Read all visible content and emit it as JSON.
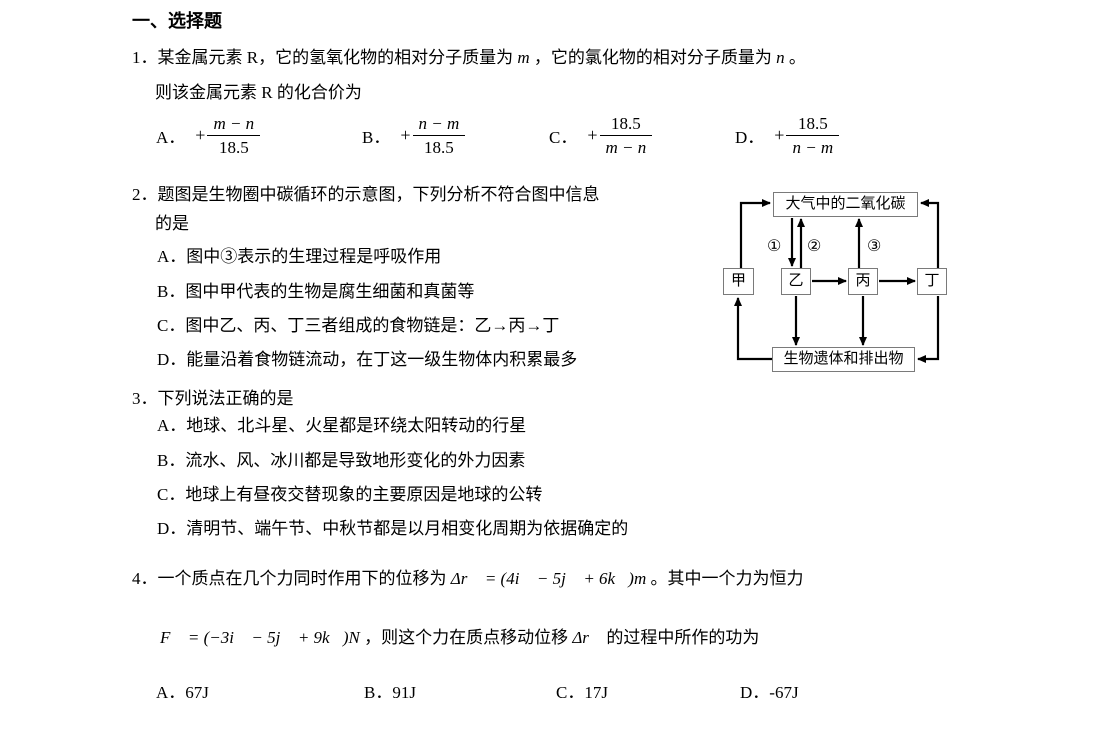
{
  "page": {
    "heading": "一、选择题"
  },
  "q1": {
    "number": "1．",
    "line1": {
      "a": "某金属元素 R，它的氢氧化物的相对分子质量为 ",
      "m": "m",
      "b": " ，它的氯化物的相对分子质量为 ",
      "n": "n",
      "c": " 。"
    },
    "line2": "则该金属元素 R 的化合价为",
    "plus": "+",
    "options": [
      {
        "label": "A．",
        "num": "m − n",
        "den": "18.5"
      },
      {
        "label": "B．",
        "num": "n − m",
        "den": "18.5"
      },
      {
        "label": "C．",
        "num": "18.5",
        "den": "m − n"
      },
      {
        "label": "D．",
        "num": "18.5",
        "den": "n − m"
      }
    ]
  },
  "q2": {
    "number": "2．",
    "line1": "题图是生物圈中碳循环的示意图，下列分析不符合图中信息",
    "line2": "的是",
    "options": [
      "A．图中③表示的生理过程是呼吸作用",
      "B．图中甲代表的生物是腐生细菌和真菌等",
      "C．图中乙、丙、丁三者组成的食物链是：乙→丙→丁",
      "D．能量沿着食物链流动，在丁这一级生物体内积累最多"
    ]
  },
  "diagram": {
    "top_box": "大气中的二氧化碳",
    "box_jia": "甲",
    "box_yi": "乙",
    "box_bing": "丙",
    "box_ding": "丁",
    "bottom_box": "生物遗体和排出物",
    "label_1": "①",
    "label_2": "②",
    "label_3": "③"
  },
  "q3": {
    "number": "3．",
    "stem": "下列说法正确的是",
    "options": [
      "A．地球、北斗星、火星都是环绕太阳转动的行星",
      "B．流水、风、冰川都是导致地形变化的外力因素",
      "C．地球上有昼夜交替现象的主要原因是地球的公转",
      "D．清明节、端午节、中秋节都是以月相变化周期为依据确定的"
    ]
  },
  "q4": {
    "number": "4．",
    "line1": {
      "t1": "一个质点在几个力同时作用下的位移为 ",
      "f1": "Δr⃗ = (4i⃗ − 5j⃗ + 6k⃗)m",
      "t2": " 。其中一个力为恒力"
    },
    "line2": {
      "f1": "F⃗ = (−3i⃗ − 5j⃗ + 9k⃗)N",
      "t1": " ，则这个力在质点移动位移 ",
      "f2": "Δr⃗",
      "t2": " 的过程中所作的功为"
    },
    "options": [
      "A．67J",
      "B．91J",
      "C．17J",
      "D．-67J"
    ]
  }
}
